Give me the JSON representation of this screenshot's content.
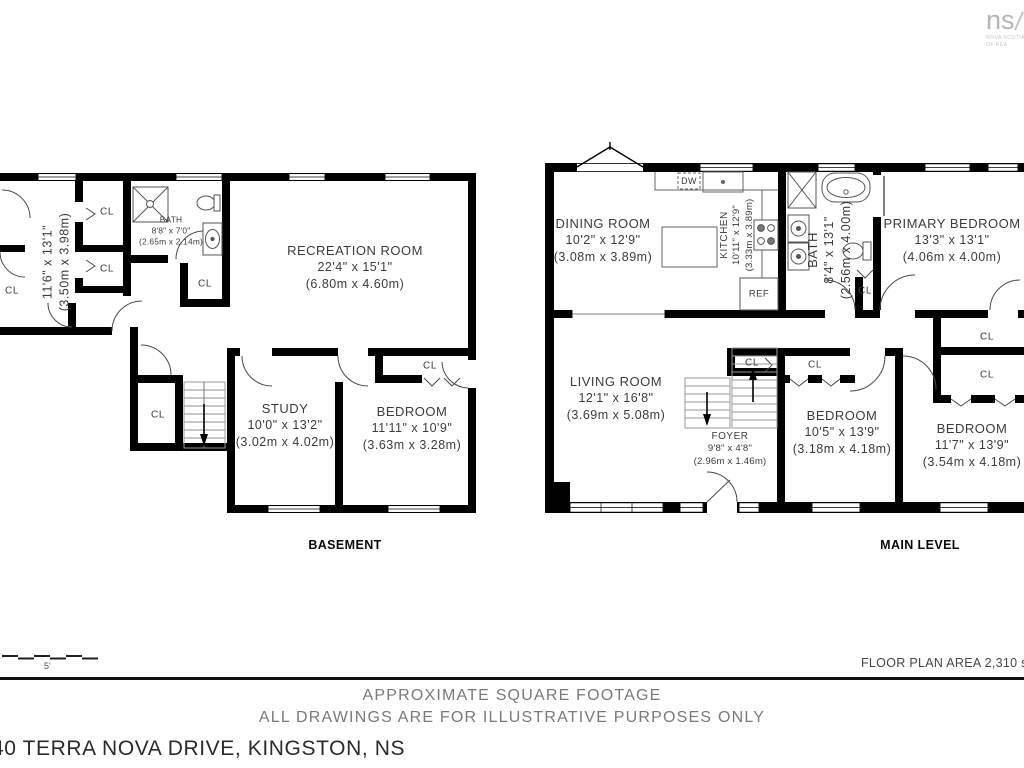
{
  "logo": {
    "mark": "ns",
    "sub1": "NOVA SCOTIA ASSOCIATION",
    "sub2": "OF REA"
  },
  "labels": {
    "closet": "CL",
    "dishwasher": "DW",
    "refrigerator": "REF"
  },
  "basement": {
    "title": "BASEMENT",
    "rooms": [
      {
        "name": "RECREATION ROOM",
        "imperial": "22'4\" x 15'1\"",
        "metric": "(6.80m x 4.60m)"
      },
      {
        "name": "STUDY",
        "imperial": "10'0\" x 13'2\"",
        "metric": "(3.02m x 4.02m)"
      },
      {
        "name": "BEDROOM",
        "imperial": "11'11\" x 10'9\"",
        "metric": "(3.63m x 3.28m)"
      },
      {
        "name": "BATH",
        "imperial": "8'8\" x 7'0\"",
        "metric": "(2.65m x 2.14m)"
      },
      {
        "name": "",
        "imperial": "11'6\" x 13'1\"",
        "metric": "(3.50m x 3.98m)"
      }
    ]
  },
  "main_level": {
    "title": "MAIN LEVEL",
    "rooms": [
      {
        "name": "DINING ROOM",
        "imperial": "10'2\" x 12'9\"",
        "metric": "(3.08m x 3.89m)"
      },
      {
        "name": "KITCHEN",
        "imperial": "10'11\" x 12'9\"",
        "metric": "(3.33m x 3.89m)"
      },
      {
        "name": "BATH",
        "imperial": "8'4\" x 13'1\"",
        "metric": "(2.56m x 4.00m)"
      },
      {
        "name": "PRIMARY BEDROOM",
        "imperial": "13'3\" x 13'1\"",
        "metric": "(4.06m x 4.00m)"
      },
      {
        "name": "LIVING ROOM",
        "imperial": "12'1\" x 16'8\"",
        "metric": "(3.69m x 5.08m)"
      },
      {
        "name": "FOYER",
        "imperial": "9'8\" x 4'8\"",
        "metric": "(2.96m x 1.46m)"
      },
      {
        "name": "BEDROOM",
        "imperial": "10'5\" x 13'9\"",
        "metric": "(3.18m x 4.18m)"
      },
      {
        "name": "BEDROOM",
        "imperial": "11'7\" x 13'9\"",
        "metric": "(3.54m x 4.18m)"
      }
    ]
  },
  "footer": {
    "scale_label": "5'",
    "area_note": "FLOOR PLAN AREA 2,310 sq.ft.",
    "line1": "APPROXIMATE SQUARE FOOTAGE",
    "line2": "ALL DRAWINGS ARE FOR ILLUSTRATIVE PURPOSES ONLY",
    "address": "40 TERRA NOVA DRIVE, KINGSTON, NS"
  }
}
